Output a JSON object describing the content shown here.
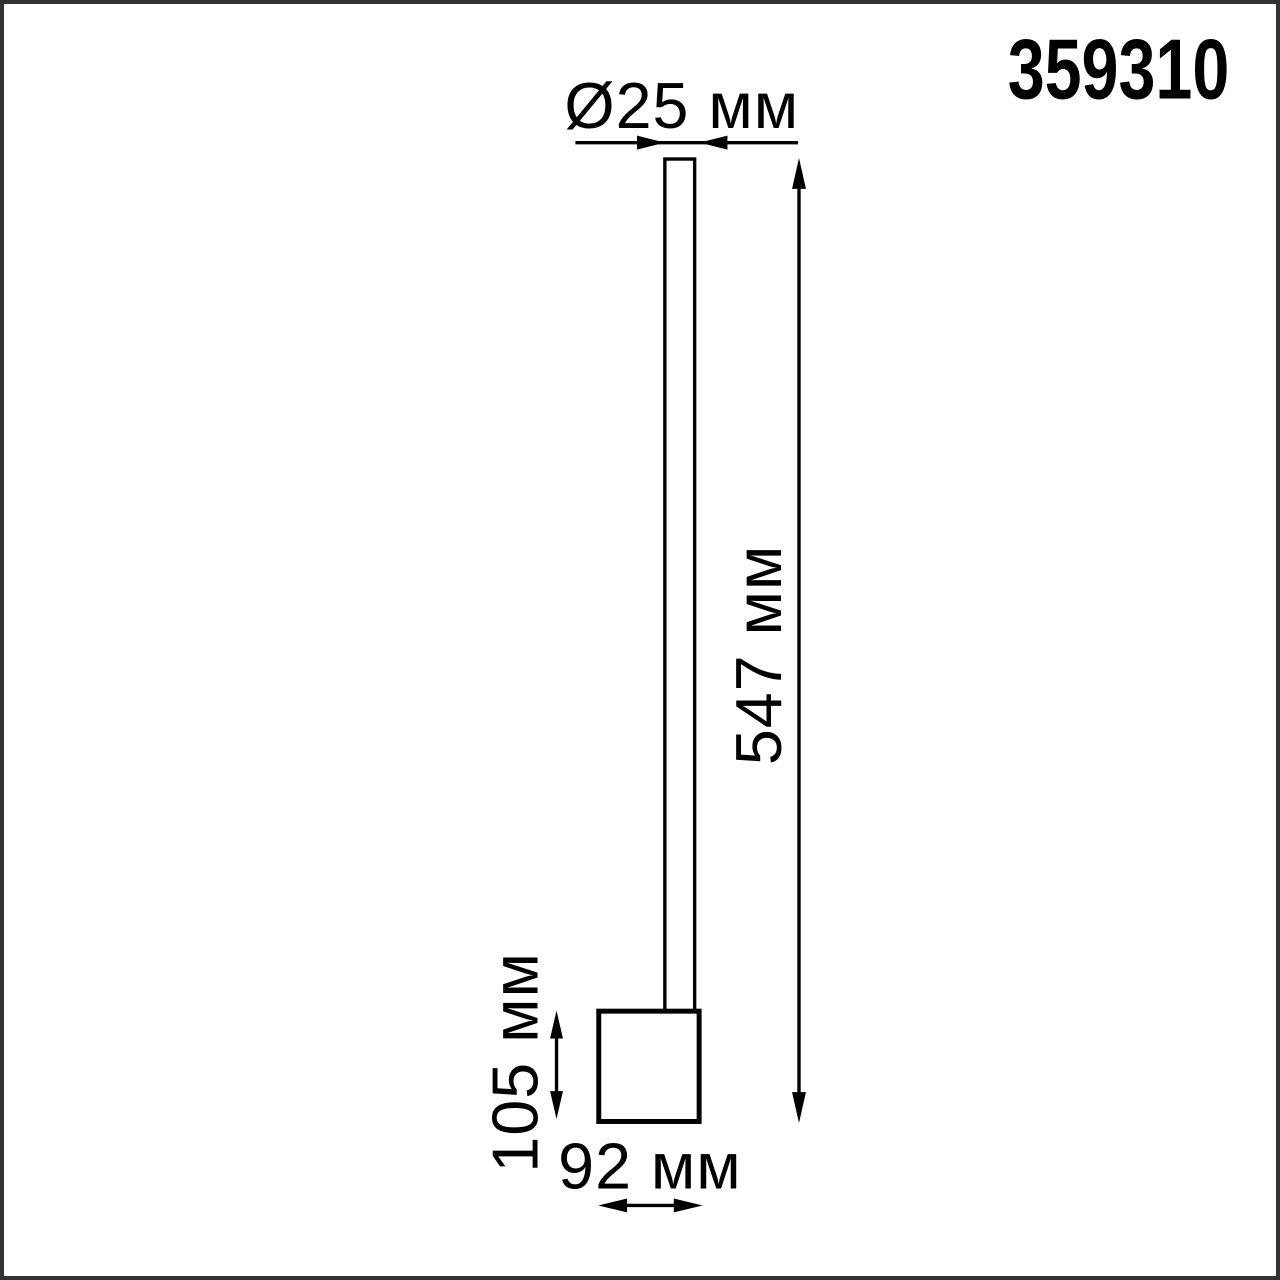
{
  "page": {
    "background_color": "#ffffff",
    "frame_color": "#333333"
  },
  "colors": {
    "line": "#000000",
    "text": "#000000",
    "shape_fill": "#ffffff"
  },
  "product": {
    "article": "359310"
  },
  "labels": {
    "diameter": "Ø25 мм",
    "total_height": "547 мм",
    "base_height": "105 мм",
    "base_width": "92 мм"
  },
  "values_mm": {
    "diameter": 25,
    "total_height": 547,
    "base_height": 105,
    "base_width": 92
  }
}
